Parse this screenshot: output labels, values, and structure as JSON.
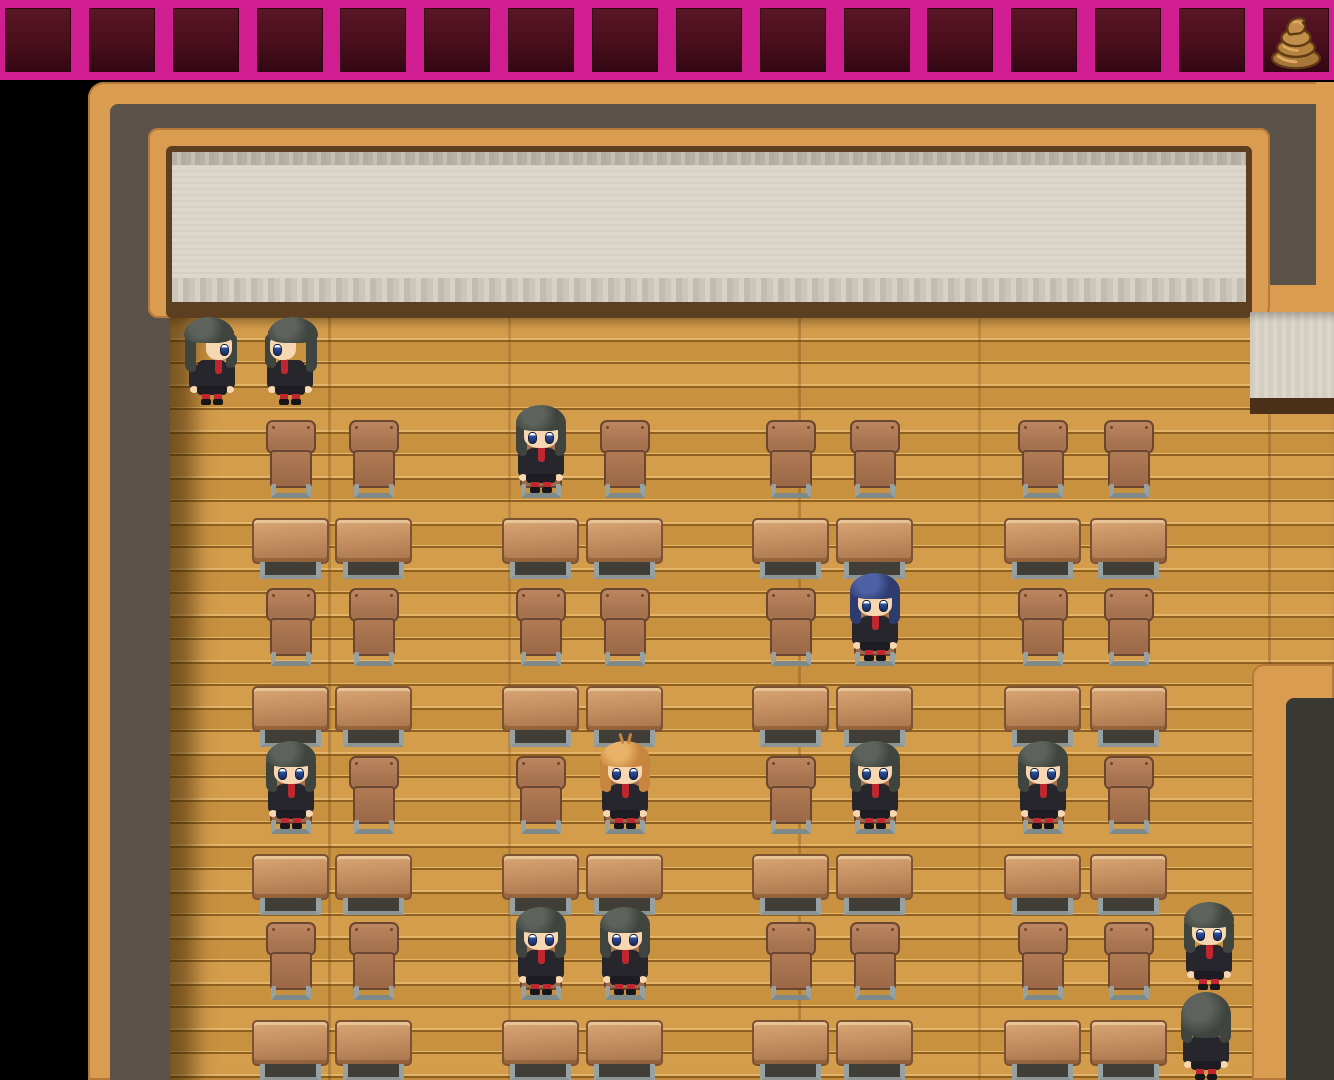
{
  "item_bar": {
    "slots": 16,
    "item_slot_index": 15,
    "item_name": "poop-icon"
  },
  "colors": {
    "bar_magenta": "#d11d92",
    "bar_cell": "#4a0e1c",
    "frame_tan": "#d99c50",
    "frame_tan_dark": "#b5793a",
    "wall_dark": "#5b5349",
    "board_cream": "#ddd6ca",
    "board_trim": "#b7b0a5",
    "tray_brown": "#5c3e20",
    "floor_light": "#d49d4c",
    "floor_mid": "#c89140",
    "floor_line": "#8f601f",
    "floor_hi": "#e4b569",
    "chair_wood": "#a5714e",
    "chair_wood_hi": "#bc8660",
    "chair_outline": "#6b4630",
    "desk_wood": "#c08a5e",
    "desk_wood_hi": "#d9a674",
    "metal": "#97a1a1",
    "uniform": "#26262c",
    "tie_red": "#bf2630",
    "skin": "#f6d7b2",
    "eye_blue": "#2b4fa2",
    "pillar_dark": "#3a3833",
    "poop_outline": "#5e3a14",
    "poop_base": "#a9763a",
    "poop_mid": "#b5823e",
    "poop_top": "#c28e49",
    "poop_hi": "#dcab60"
  },
  "layout": {
    "chair_columns_x": [
      266,
      349,
      516,
      600,
      766,
      850,
      1018,
      1104
    ],
    "chair_rows_y": [
      420,
      588,
      756,
      922
    ],
    "desk_columns_x": [
      252,
      335,
      502,
      586,
      752,
      836,
      1004,
      1090
    ],
    "desk_rows_y": [
      518,
      686,
      854,
      1020
    ],
    "chair_size": [
      50,
      78
    ],
    "desk_size": [
      77,
      62
    ]
  },
  "empty_chairs": [
    [
      0,
      0
    ],
    [
      0,
      1
    ],
    [
      0,
      3
    ],
    [
      0,
      4
    ],
    [
      0,
      5
    ],
    [
      0,
      6
    ],
    [
      0,
      7
    ],
    [
      1,
      0
    ],
    [
      1,
      1
    ],
    [
      1,
      2
    ],
    [
      1,
      3
    ],
    [
      1,
      4
    ],
    [
      1,
      6
    ],
    [
      1,
      7
    ],
    [
      2,
      1
    ],
    [
      2,
      2
    ],
    [
      2,
      4
    ],
    [
      2,
      7
    ],
    [
      3,
      0
    ],
    [
      3,
      1
    ],
    [
      3,
      4
    ],
    [
      3,
      5
    ],
    [
      3,
      6
    ],
    [
      3,
      7
    ]
  ],
  "hair_colors": {
    "dark": {
      "base": "#3f443f",
      "hi": "#5d635c"
    },
    "blue": {
      "base": "#2e3b6f",
      "hi": "#4d62a5"
    },
    "orange": {
      "base": "#c8853f",
      "hi": "#e7b268"
    }
  },
  "students": [
    {
      "pose": "stand",
      "facing": "right",
      "hair": "dark",
      "x": 186,
      "y": 318
    },
    {
      "pose": "stand",
      "facing": "left",
      "hair": "dark",
      "x": 264,
      "y": 318
    },
    {
      "pose": "sit",
      "facing": "down",
      "hair": "dark",
      "row": 0,
      "col": 2
    },
    {
      "pose": "sit",
      "facing": "down",
      "hair": "blue",
      "row": 1,
      "col": 5
    },
    {
      "pose": "sit",
      "facing": "down",
      "hair": "dark",
      "row": 2,
      "col": 0
    },
    {
      "pose": "sit",
      "facing": "down",
      "hair": "orange",
      "row": 2,
      "col": 3
    },
    {
      "pose": "sit",
      "facing": "down",
      "hair": "dark",
      "row": 2,
      "col": 5
    },
    {
      "pose": "sit",
      "facing": "down",
      "hair": "dark",
      "row": 2,
      "col": 6
    },
    {
      "pose": "sit",
      "facing": "down",
      "hair": "dark",
      "row": 3,
      "col": 2
    },
    {
      "pose": "sit",
      "facing": "down",
      "hair": "dark",
      "row": 3,
      "col": 3
    },
    {
      "pose": "stand",
      "facing": "down",
      "hair": "dark",
      "x": 1183,
      "y": 903
    },
    {
      "pose": "stand",
      "facing": "up",
      "hair": "dark",
      "x": 1180,
      "y": 993
    }
  ]
}
